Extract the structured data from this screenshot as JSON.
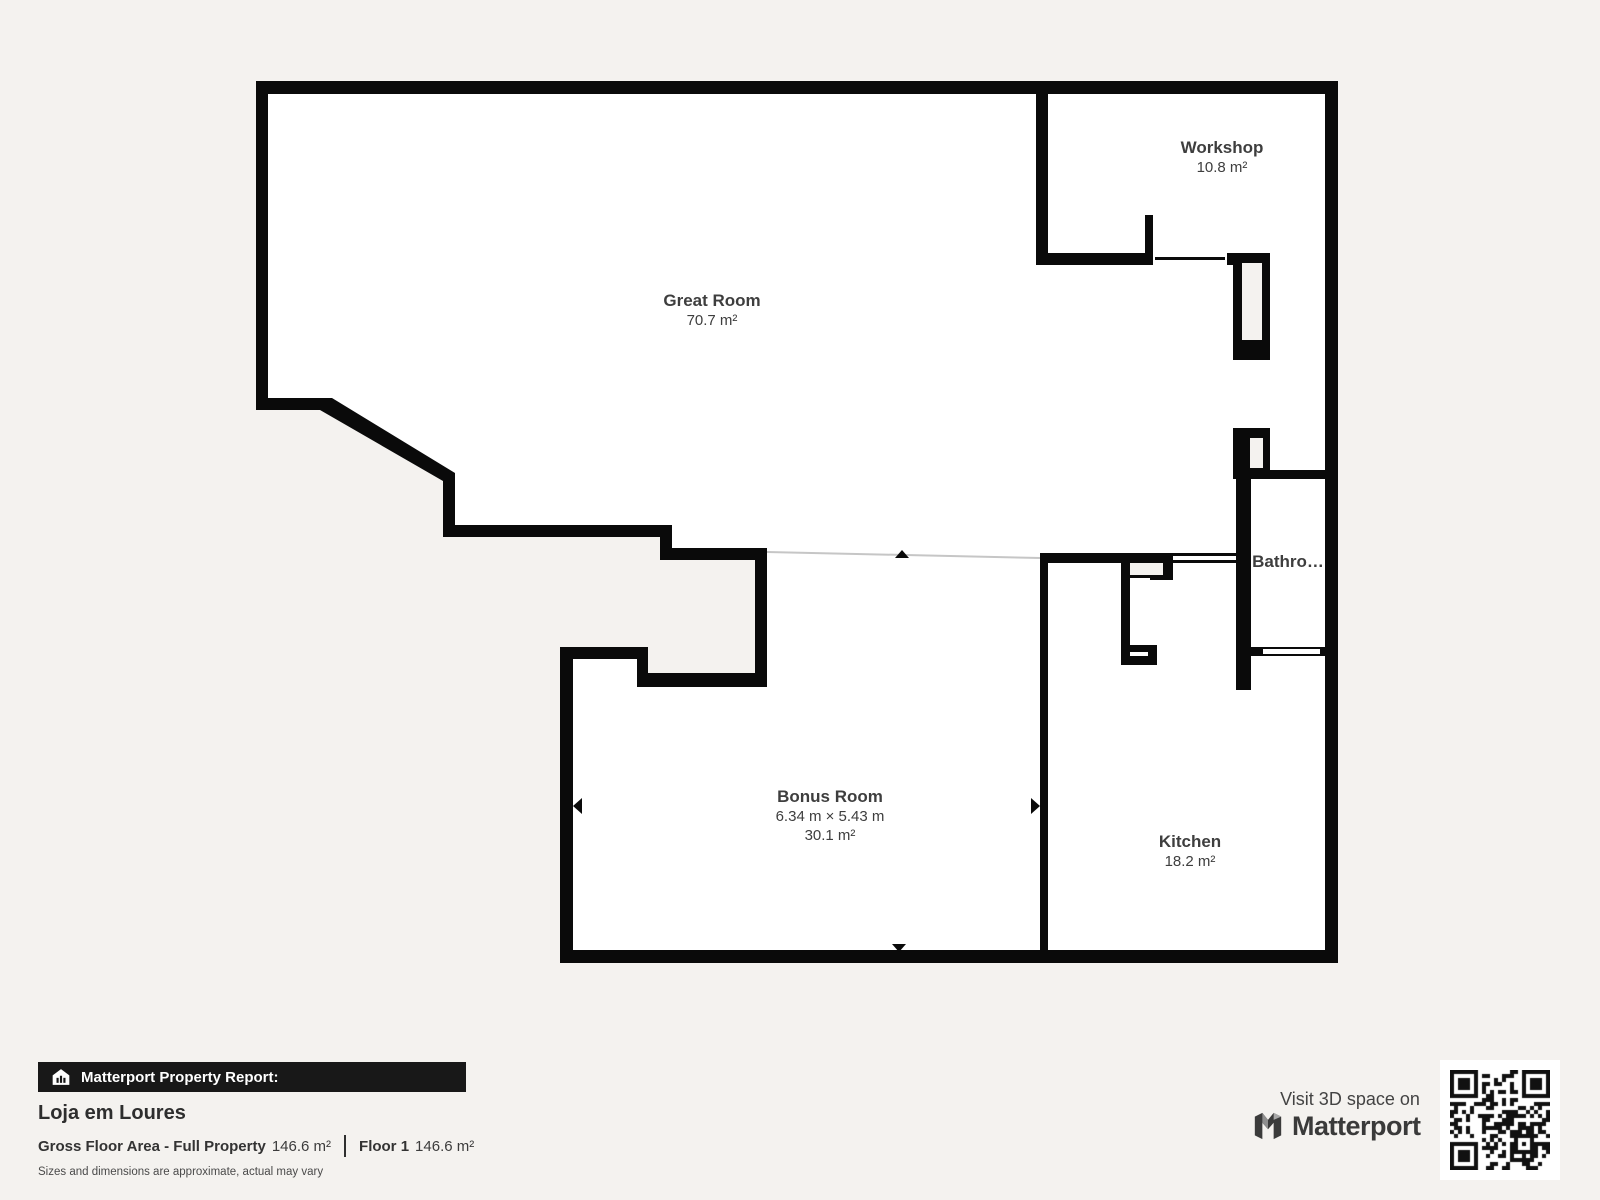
{
  "colors": {
    "background": "#f4f2ef",
    "wall": "#0a0a0a",
    "interior": "#ffffff",
    "label_text": "#3e3e3e",
    "bar_background": "#181818",
    "virtual_line": "#c6c6c6"
  },
  "floorplan": {
    "rooms": [
      {
        "id": "great-room",
        "name": "Great Room",
        "area": "70.7 m²"
      },
      {
        "id": "workshop",
        "name": "Workshop",
        "area": "10.8 m²"
      },
      {
        "id": "bathroom",
        "name": "Bathro…"
      },
      {
        "id": "bonus-room",
        "name": "Bonus Room",
        "dimensions": "6.34 m × 5.43 m",
        "area": "30.1 m²"
      },
      {
        "id": "kitchen",
        "name": "Kitchen",
        "area": "18.2 m²"
      }
    ]
  },
  "report": {
    "bar_label": "Matterport Property Report:",
    "property_name": "Loja em Loures",
    "gross_floor_label": "Gross Floor Area - Full Property",
    "gross_floor_value": "146.6 m²",
    "floor_label": "Floor 1",
    "floor_value": "146.6 m²",
    "disclaimer": "Sizes and dimensions are approximate, actual may vary"
  },
  "footer": {
    "visit_text": "Visit 3D space on",
    "brand": "Matterport"
  },
  "icons": {
    "report_bar_icon": "house-chart-icon",
    "brand_icon": "matterport-logo",
    "qr": "qr-code"
  }
}
